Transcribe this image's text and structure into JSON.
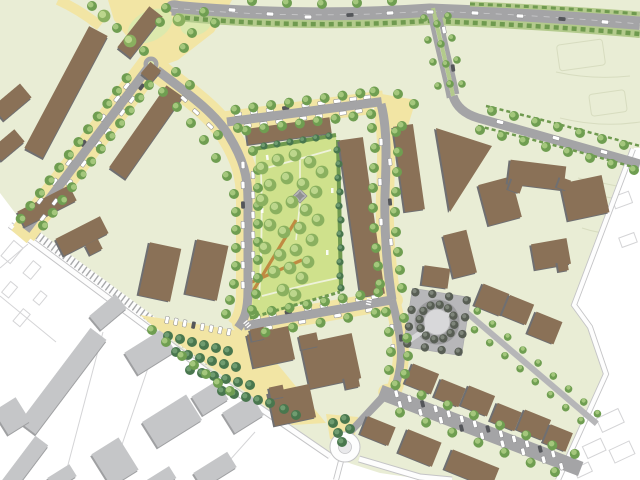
{
  "meta": {
    "app": "site-plan",
    "description": "Aerial urban masterplan site plan: a new residential district (pale green) with brown slab and perimeter buildings, a central triangular park with lawn and tree groves, tree-lined streets with parked cars, a yellow grove plaza, a circular paved plaza with a tree ring, a roundabout, a curving arterial road at top, a railway line on the south-west boundary and white existing-city context areas with grey buildings.",
    "canvas_width": 640,
    "canvas_height": 480,
    "visible_text": "none"
  },
  "colors": {
    "plan_bg": "#e9edd5",
    "context_bg": "#ffffff",
    "context_building": "#c5c6c8",
    "context_building_shadow": "#9fa0a2",
    "context_road": "#cdcdcf",
    "ghost_white": "#d4d4d6",
    "ghost_green": "#d7dcbf",
    "building": "#8a7157",
    "building_shadow": "#6f6f71",
    "road": "#a4a4a6",
    "road_light": "#b6b6b8",
    "casing": "#c4c4c6",
    "street_yellow": "#f2e5a4",
    "park_lawn": "#cfe18c",
    "lawn_light": "#dce9ad",
    "hedge": "#6f9a4f",
    "verge": "#b3ca8c",
    "tree_base": "#6f9e51",
    "tree_hi": "#a4c77c",
    "parktree_base": "#8ab05f",
    "parktree_hi": "#bcd68c",
    "darktree_base": "#49774e",
    "darktree_hi": "#6f9c70",
    "ringtree_base": "#585e54",
    "ringtree_hi": "#7e857a",
    "plaza_gray": "#b7b7b9",
    "plaza_inner": "#d8d8da",
    "orange_path": "#c08a42",
    "car": "#ffffff",
    "car_dark": "#54565a",
    "car_stroke": "#8a8a8c",
    "railway": "#a7a8aa",
    "zebra": "#ffffff",
    "path_white": "#eef2da"
  },
  "features": [
    {
      "name": "arterial-road",
      "kind": "road"
    },
    {
      "name": "boulevard-avenue",
      "kind": "road"
    },
    {
      "name": "residential-streets",
      "kind": "road"
    },
    {
      "name": "parking-street",
      "kind": "road"
    },
    {
      "name": "tree-lined-lane",
      "kind": "path"
    },
    {
      "name": "railway-line",
      "kind": "rail"
    },
    {
      "name": "roundabout",
      "kind": "road"
    },
    {
      "name": "mini-roundabout",
      "kind": "road"
    },
    {
      "name": "central-park",
      "kind": "green-space"
    },
    {
      "name": "pocket-park",
      "kind": "green-space"
    },
    {
      "name": "tree-grove-plaza",
      "kind": "plaza"
    },
    {
      "name": "circular-plaza",
      "kind": "plaza"
    },
    {
      "name": "new-residential-buildings",
      "kind": "building"
    },
    {
      "name": "existing-context-buildings",
      "kind": "building"
    },
    {
      "name": "street-trees",
      "kind": "vegetation"
    },
    {
      "name": "parked-cars",
      "kind": "vehicle"
    }
  ]
}
